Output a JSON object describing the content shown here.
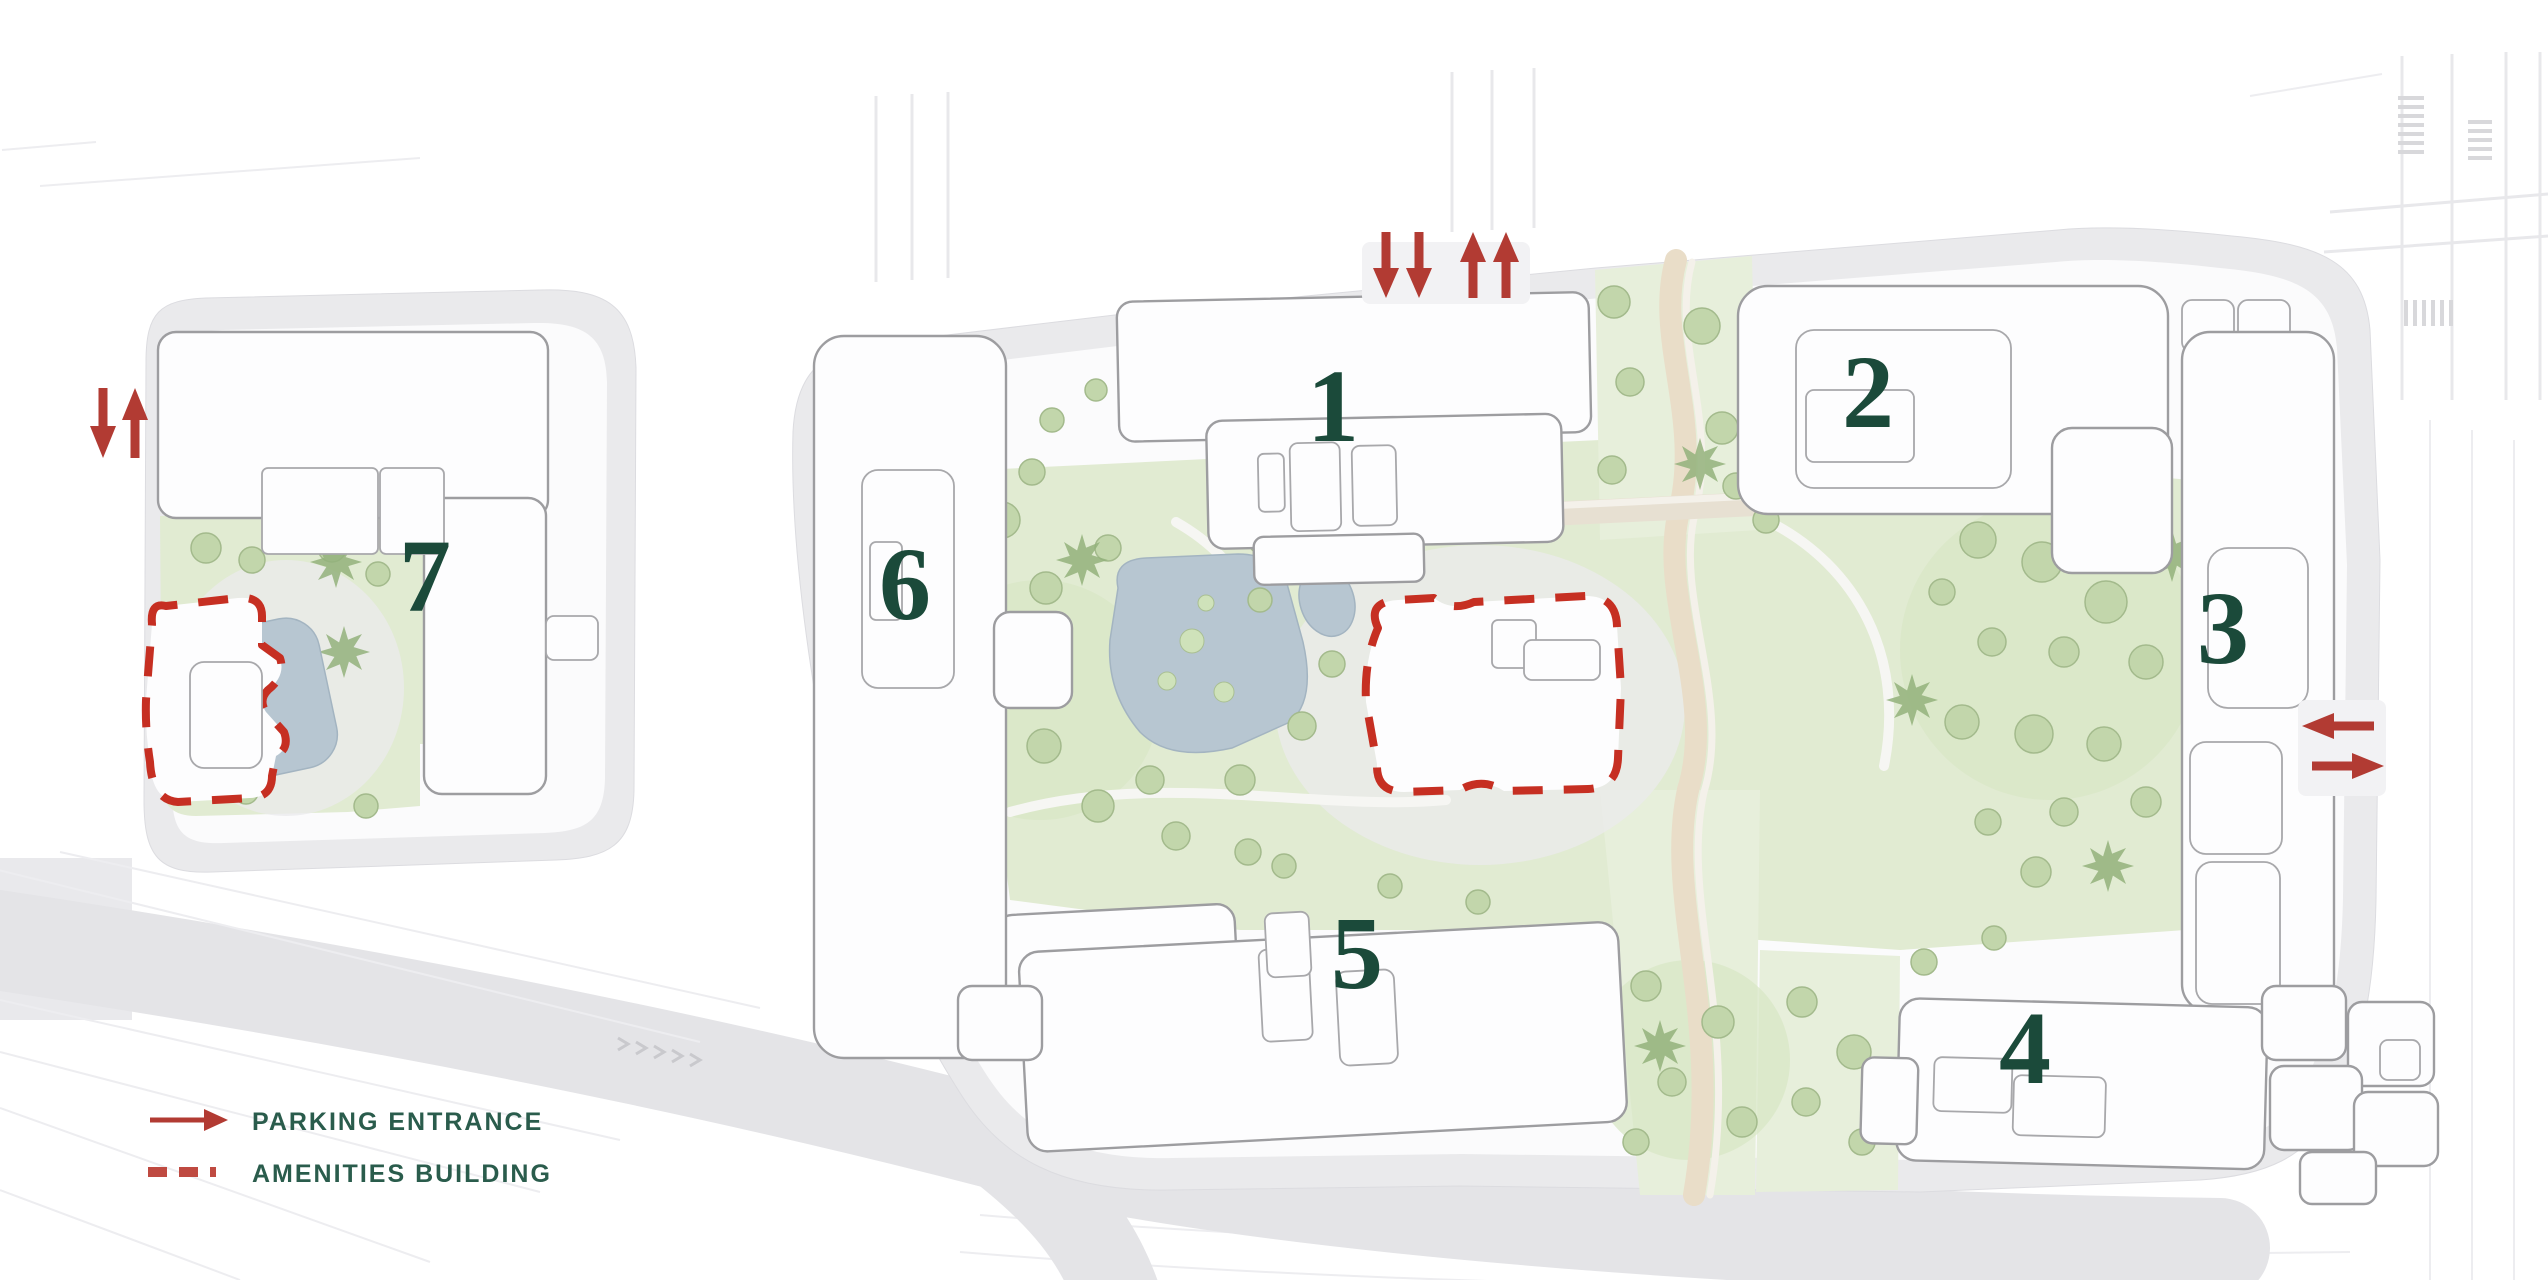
{
  "map": {
    "kind": "residential-site-plan",
    "parcels": [
      "west-parcel",
      "main-parcel"
    ]
  },
  "buildings": [
    {
      "number": "1"
    },
    {
      "number": "2"
    },
    {
      "number": "3"
    },
    {
      "number": "4"
    },
    {
      "number": "5"
    },
    {
      "number": "6"
    },
    {
      "number": "7"
    }
  ],
  "legend": {
    "items": [
      {
        "id": "parking-entrance",
        "label": "PARKING ENTRANCE",
        "symbol": "red-arrow",
        "color": "#b23b33"
      },
      {
        "id": "amenities-building",
        "label": "AMENITIES BUILDING",
        "symbol": "red-dashed-line",
        "color": "#bf4a41"
      }
    ]
  },
  "markers": {
    "parking_entrances": [
      {
        "location": "north",
        "arrows": [
          "down",
          "down",
          "up",
          "up"
        ]
      },
      {
        "location": "west",
        "arrows": [
          "down",
          "up"
        ]
      },
      {
        "location": "east",
        "arrows": [
          "left",
          "right"
        ]
      }
    ],
    "amenities_buildings": [
      {
        "location": "central-park"
      },
      {
        "location": "west-parcel"
      }
    ]
  },
  "colors": {
    "arrow_red": "#b23b33",
    "amenity_outline_red": "#c62f22",
    "building_number_green": "#1b4a3a",
    "legend_text_green": "#2a5c4c",
    "landscape_green": "#e1ebd2",
    "tree_green": "#c2d6ab",
    "water_blue": "#b7c6d1",
    "parcel_grey": "#eaeaec",
    "road_grey": "#e4e4e7",
    "building_fill": "#fdfdfe"
  }
}
